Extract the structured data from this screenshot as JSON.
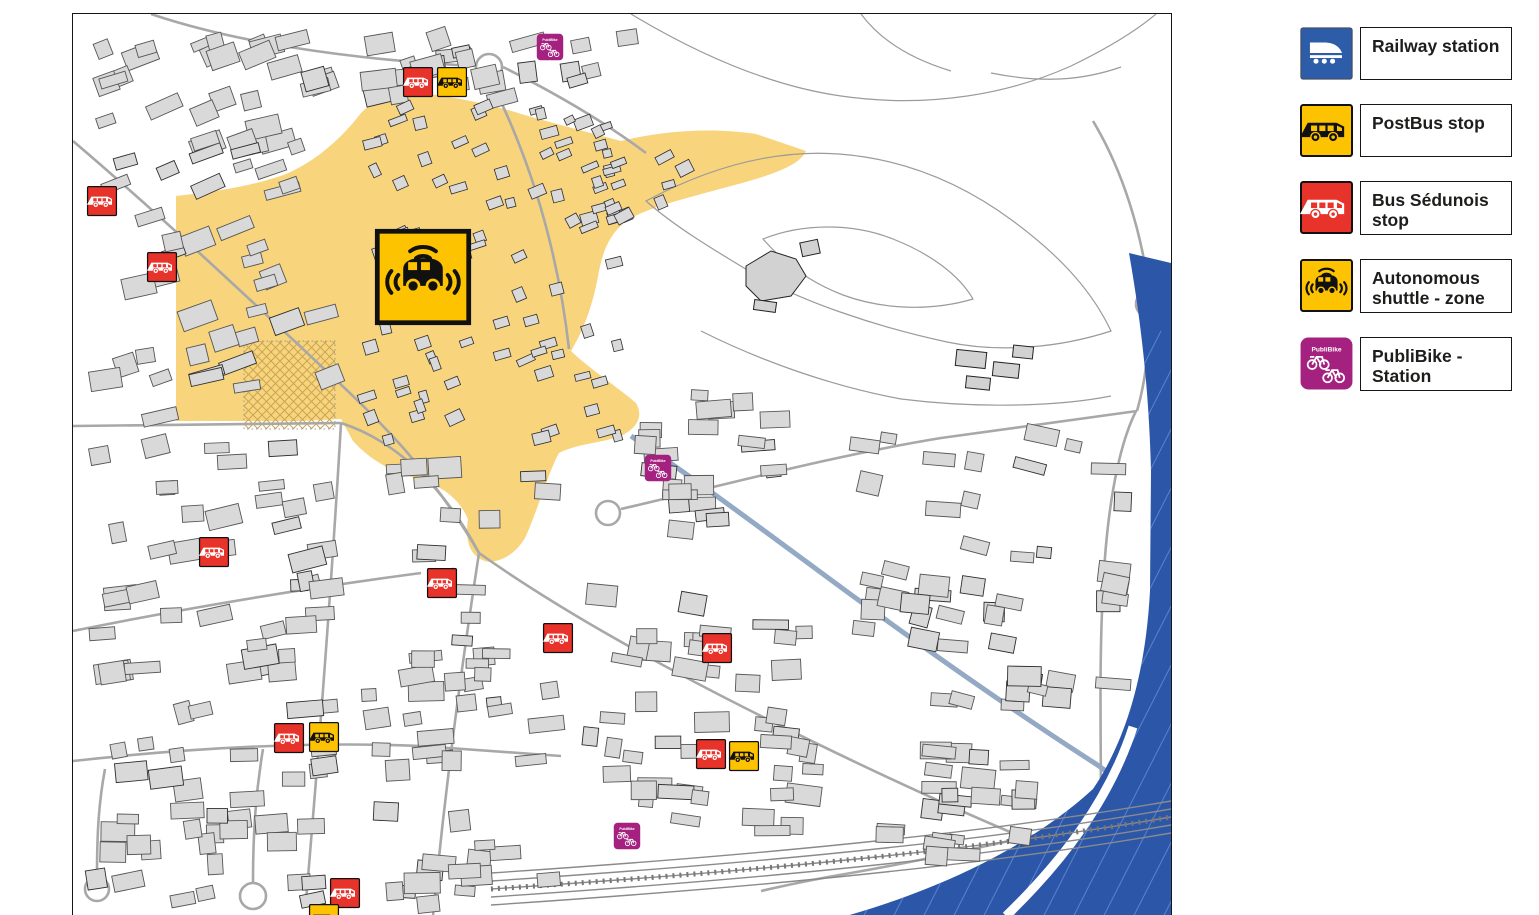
{
  "legend": {
    "items": [
      {
        "id": "railway",
        "label": "Railway station",
        "icon": "train-icon",
        "color": "#2d5ca9",
        "fg": "#ffffff"
      },
      {
        "id": "postbus",
        "label": "PostBus stop",
        "icon": "postbus-icon",
        "color": "#fdc300",
        "fg": "#111111"
      },
      {
        "id": "bus_sedunois",
        "label": "Bus Sédunois stop",
        "icon": "bus-icon",
        "color": "#e8332a",
        "fg": "#ffffff"
      },
      {
        "id": "shuttle",
        "label": "Autonomous shuttle - zone",
        "icon": "shuttle-icon",
        "color": "#fdc300",
        "fg": "#111111"
      },
      {
        "id": "publibike",
        "label": "PubliBike - Station",
        "icon": "publibike-icon",
        "color": "#a5217f",
        "fg": "#ffffff",
        "icon_text": "PubliBike"
      }
    ]
  },
  "map": {
    "colors": {
      "zone_yellow": "#f8d47c",
      "river_blue": "#2c57a8",
      "river_hatch": "#5c83cc",
      "canal_blue": "#93a9c4",
      "postbus_yellow": "#fdc300",
      "bus_red": "#e8332a",
      "publibike_magenta": "#a5217f",
      "railway_blue": "#2d5ca9",
      "building_fill": "#d9d9d9",
      "building_stroke": "#555555",
      "street_gray": "#a8a8a8"
    },
    "markers": [
      {
        "type": "bus_sedunois",
        "x": 101,
        "y": 200
      },
      {
        "type": "bus_sedunois",
        "x": 161,
        "y": 266
      },
      {
        "type": "bus_sedunois",
        "x": 417,
        "y": 81
      },
      {
        "type": "postbus",
        "x": 451,
        "y": 81
      },
      {
        "type": "bus_sedunois",
        "x": 213,
        "y": 551
      },
      {
        "type": "bus_sedunois",
        "x": 441,
        "y": 582
      },
      {
        "type": "bus_sedunois",
        "x": 557,
        "y": 637
      },
      {
        "type": "bus_sedunois",
        "x": 716,
        "y": 647
      },
      {
        "type": "bus_sedunois",
        "x": 288,
        "y": 737
      },
      {
        "type": "postbus",
        "x": 323,
        "y": 736
      },
      {
        "type": "bus_sedunois",
        "x": 710,
        "y": 753
      },
      {
        "type": "postbus",
        "x": 743,
        "y": 755
      },
      {
        "type": "bus_sedunois",
        "x": 344,
        "y": 892
      },
      {
        "type": "postbus",
        "x": 323,
        "y": 918
      },
      {
        "type": "publibike",
        "x": 549,
        "y": 46
      },
      {
        "type": "publibike",
        "x": 657,
        "y": 467
      },
      {
        "type": "publibike",
        "x": 626,
        "y": 835
      }
    ],
    "shuttle_zone_icon": {
      "x": 422,
      "y": 276,
      "size": 95
    }
  }
}
